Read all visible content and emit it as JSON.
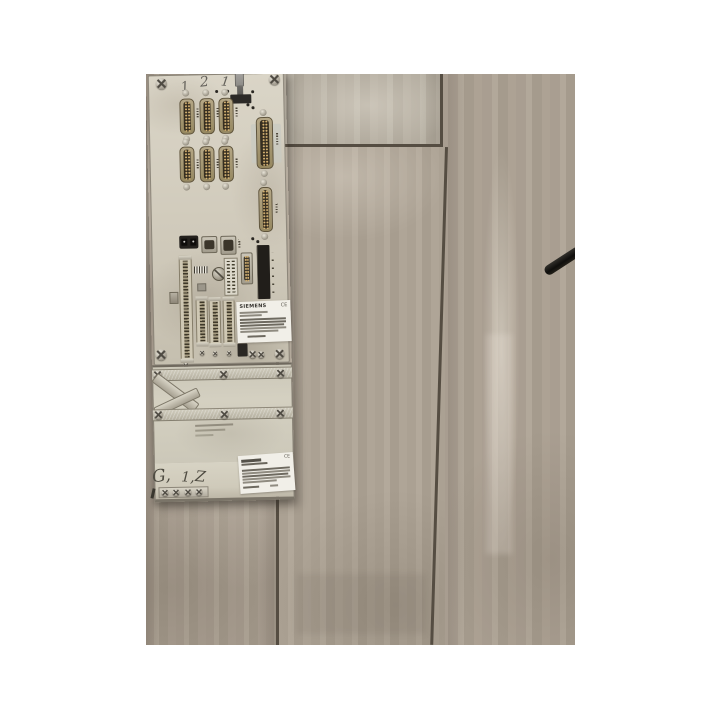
{
  "scene": {
    "type": "photograph",
    "subject": "Beige industrial control module rear connector panel lying on gray wood-look tile floor",
    "background_color": "#ffffff"
  },
  "floor": {
    "tile_color": "#a89d90",
    "tile_light_color": "#b4ada1",
    "grout_color": "#554d42",
    "cable_color": "#15130f"
  },
  "device": {
    "panel_color": "#d4cfc0",
    "handwritten_top_marks": [
      "1",
      "2",
      "1"
    ],
    "handwritten_bottom_marks": [
      "G,",
      "1,",
      "Z"
    ],
    "product_label": {
      "brand": "SIEMENS",
      "ce_mark": "CE"
    },
    "bottom_label": {
      "ce_mark": "CE"
    },
    "connectors": {
      "db25_grid_count": 6,
      "right_column": [
        "DB37 female",
        "DB25"
      ],
      "mid_row": [
        "dual socket",
        "DB9",
        "DB9"
      ],
      "center_parts": [
        "terminal strip",
        "rotary switch",
        "pin header",
        "DB15",
        "card slot"
      ],
      "terminal_strip_count": 4,
      "toggle_switch": true
    }
  }
}
